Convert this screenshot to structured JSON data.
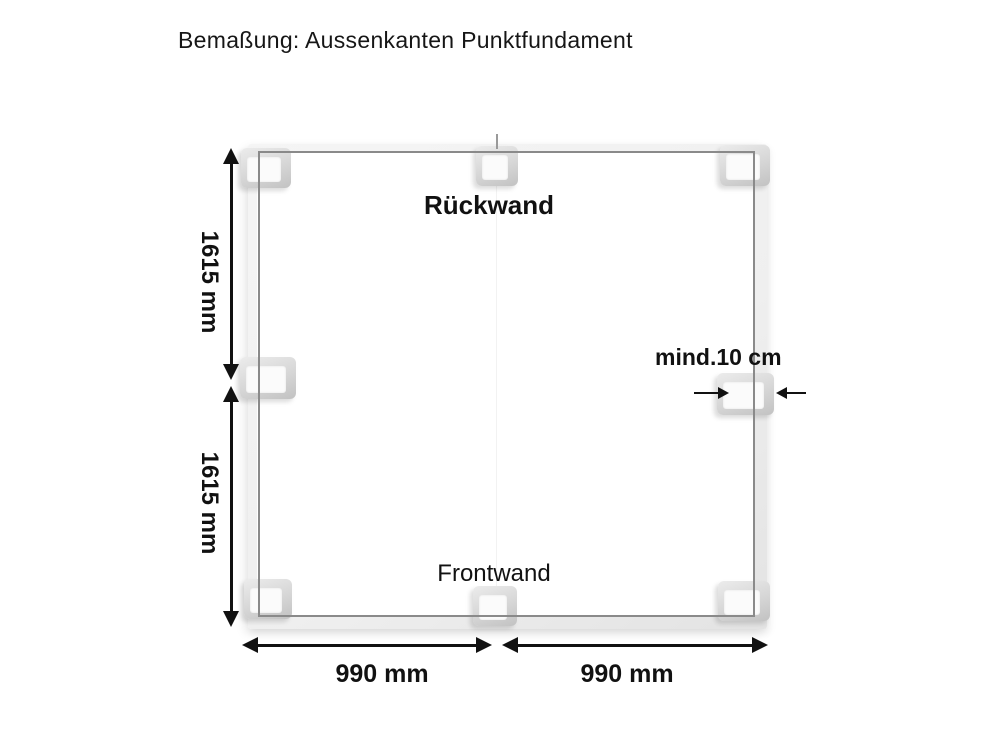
{
  "title": "Bemaßung: Aussenkanten Punktfundament",
  "diagram": {
    "back_wall_label": "Rückwand",
    "front_wall_label": "Frontwand",
    "clearance_label": "mind.10 cm",
    "dims": {
      "left_upper": "1615 mm",
      "left_lower": "1615 mm",
      "bottom_left": "990 mm",
      "bottom_right": "990 mm"
    },
    "foundation_block_count": 8,
    "colors": {
      "background": "#ffffff",
      "text": "#111111",
      "dimension_line": "#111111",
      "frame_edge": "#8a8a8a",
      "beam_fill": "#f0f0f0",
      "block_fill": "#d6d6d6"
    }
  }
}
